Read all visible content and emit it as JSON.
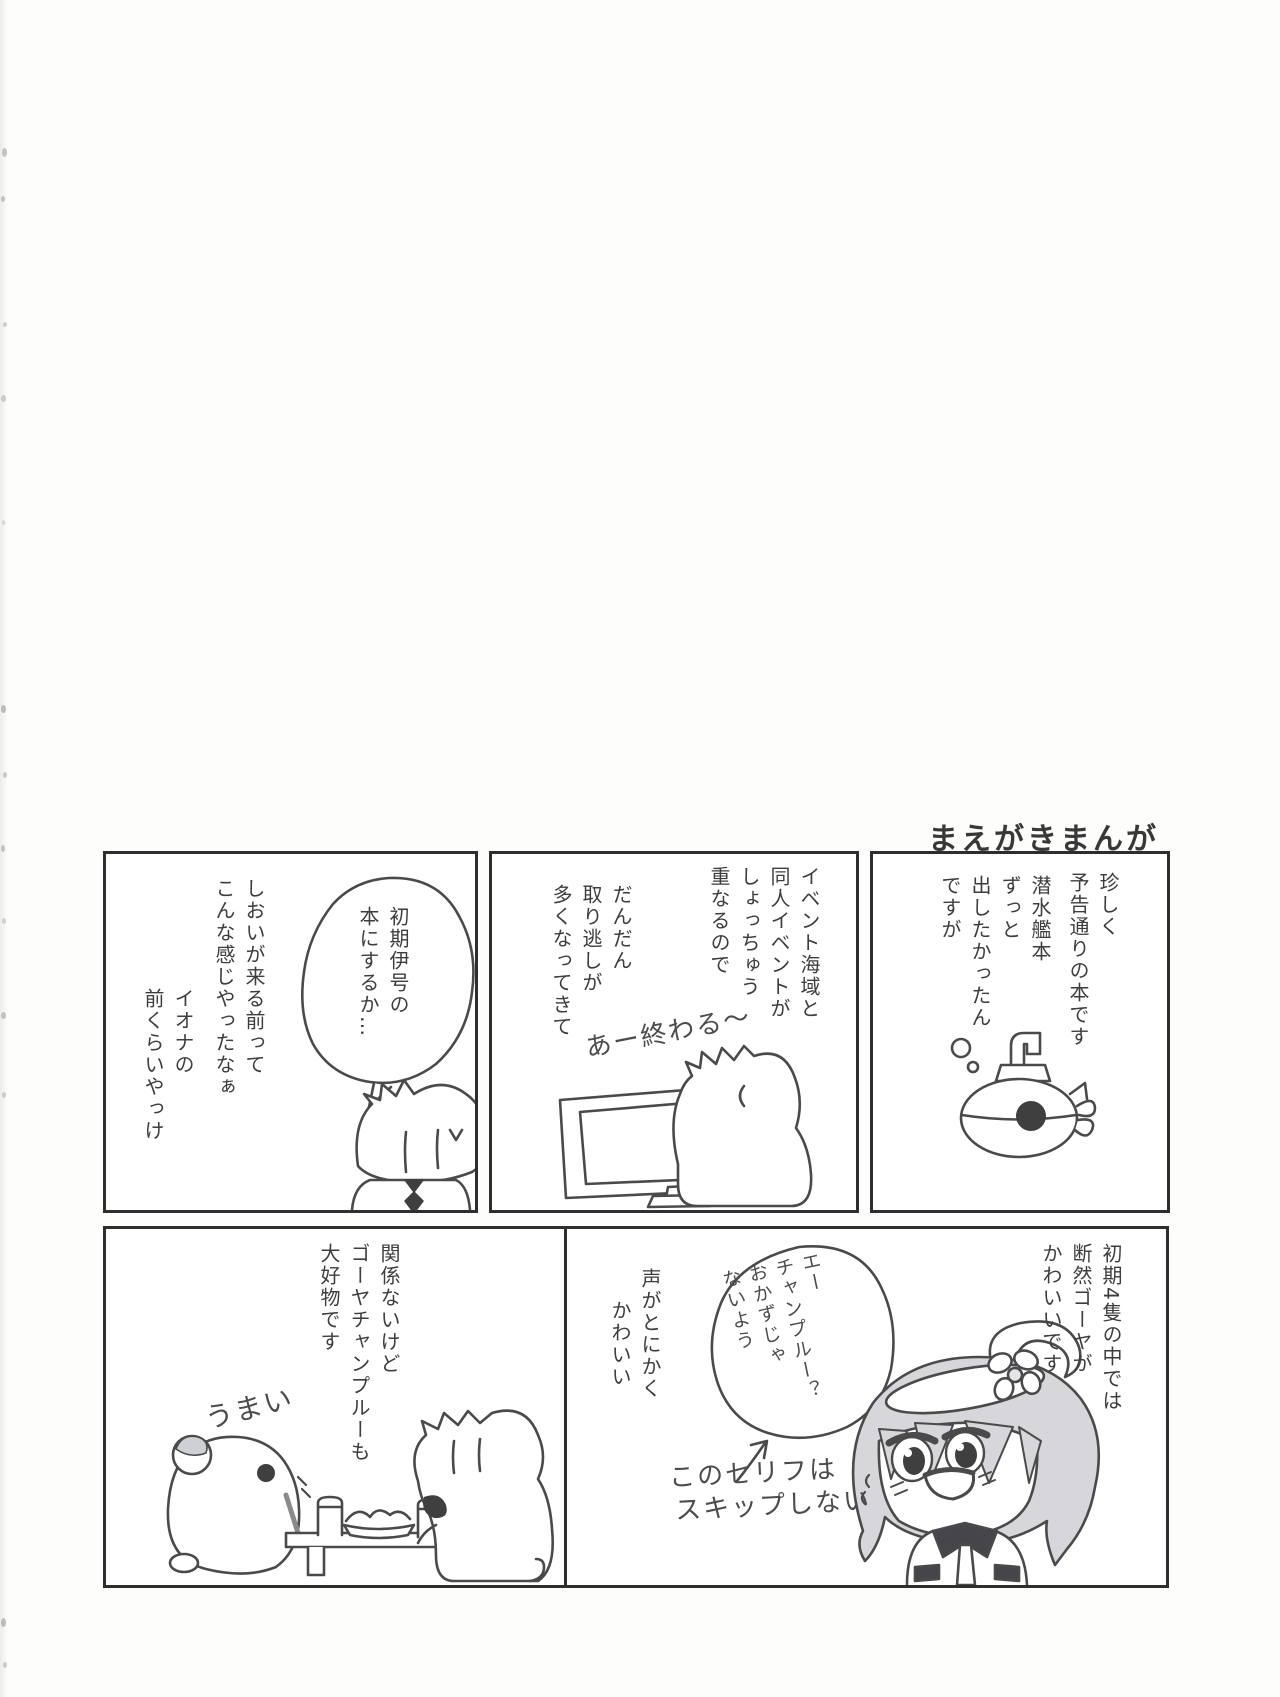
{
  "page": {
    "title": "まえがきまんが"
  },
  "colors": {
    "ink": "#3d3d3d",
    "paper": "#ffffff",
    "hair_shade": "#d6d6db"
  },
  "panels": {
    "p1": {
      "narration1": [
        "珍しく",
        "予告通りの本です"
      ],
      "narration2": [
        "潜水艦本",
        "ずっと",
        "出したかったん",
        "ですが"
      ]
    },
    "p2": {
      "narration1": [
        "イベント海域と",
        "同人イベントが",
        "しょっちゅう",
        "重なるので"
      ],
      "narration2": [
        "だんだん",
        "取り逃しが",
        "多くなってきて"
      ],
      "handwriting": "あー終わる〜"
    },
    "p3": {
      "narration1": [
        "しおいが来る前って",
        "こんな感じやったなぁ"
      ],
      "narration2": [
        "イオナの",
        "前くらいやっけ"
      ],
      "bubble": [
        "初期伊号の",
        "本にするか…"
      ]
    },
    "p4": {
      "narration1": [
        "初期4隻の中では",
        "断然ゴーヤが",
        "かわいいです"
      ],
      "bubble": [
        "エー",
        "チャンプルー？",
        "おかずじゃ",
        "ないよう"
      ],
      "note": [
        "声がとにかく",
        "かわいい"
      ],
      "caption_line1": "このセリフは",
      "caption_line2": "スキップしない"
    },
    "p5": {
      "narration1": [
        "関係ないけど",
        "ゴーヤチャンプルーも",
        "大好物です"
      ],
      "handwriting": "うまい"
    }
  }
}
